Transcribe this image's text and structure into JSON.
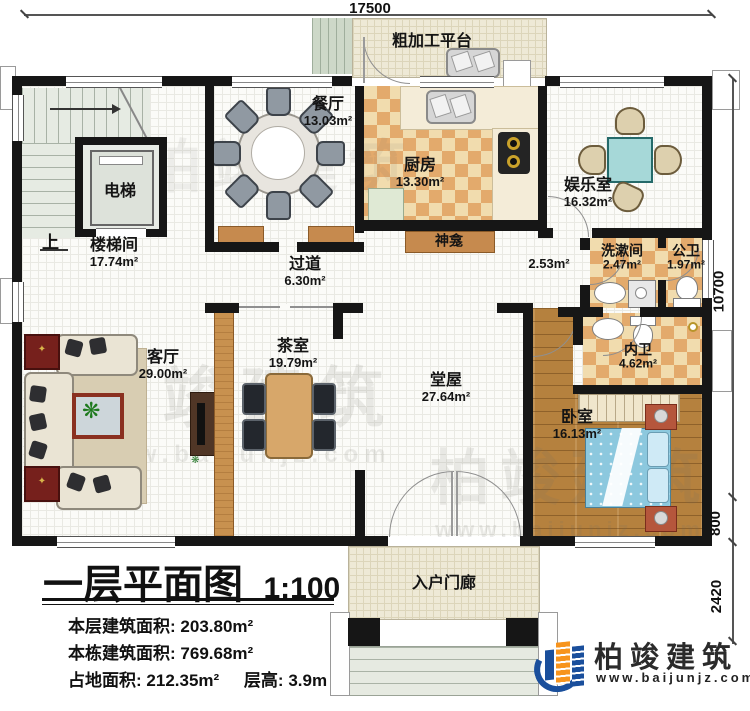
{
  "dims": {
    "top": "17500",
    "right_upper": "10700",
    "right_mid": "800",
    "right_lower": "2420"
  },
  "rooms": {
    "stairhall": {
      "name": "楼梯间",
      "area": "17.74m²"
    },
    "dining": {
      "name": "餐厅",
      "area": "13.03m²"
    },
    "kitchen": {
      "name": "厨房",
      "area": "13.30m²"
    },
    "entertainment": {
      "name": "娱乐室",
      "area": "16.32m²"
    },
    "corridor": {
      "name": "过道",
      "area": "6.30m²"
    },
    "living": {
      "name": "客厅",
      "area": "29.00m²"
    },
    "tearoom": {
      "name": "茶室",
      "area": "19.79m²"
    },
    "hall": {
      "name": "堂屋",
      "area": "27.64m²"
    },
    "bedroom": {
      "name": "卧室",
      "area": "16.13m²"
    },
    "washroom": {
      "name": "洗漱间",
      "area": "2.47m²"
    },
    "public_bath": {
      "name": "公卫",
      "area": "1.97m²"
    },
    "private_bath": {
      "name": "内卫",
      "area": "4.62m²"
    },
    "vestibule_area": "2.53m²"
  },
  "labels": {
    "platform": "粗加工平台",
    "shrine": "神龛",
    "porch": "入户门廊",
    "elevator": "电梯",
    "up": "上"
  },
  "title_block": {
    "title": "一层平面图",
    "scale": "1:100",
    "line1_label": "本层建筑面积:",
    "line1_value": "203.80m²",
    "line2_label": "本栋建筑面积:",
    "line2_value": "769.68m²",
    "line3_label": "占地面积:",
    "line3_value": "212.35m²",
    "line4_label": "层高:",
    "line4_value": "3.9m"
  },
  "brand": {
    "name": "柏竣建筑",
    "url": "www.baijunjz.com"
  },
  "watermark": {
    "name": "柏竣建筑",
    "url": "www.baijunjz.com"
  },
  "colors": {
    "wall": "#161616",
    "checker": "#e3aa6c",
    "wood": "#b5813e",
    "bed": "#8cc8de",
    "brand_blue": "#1a4f9c",
    "brand_orange": "#f7941d"
  }
}
